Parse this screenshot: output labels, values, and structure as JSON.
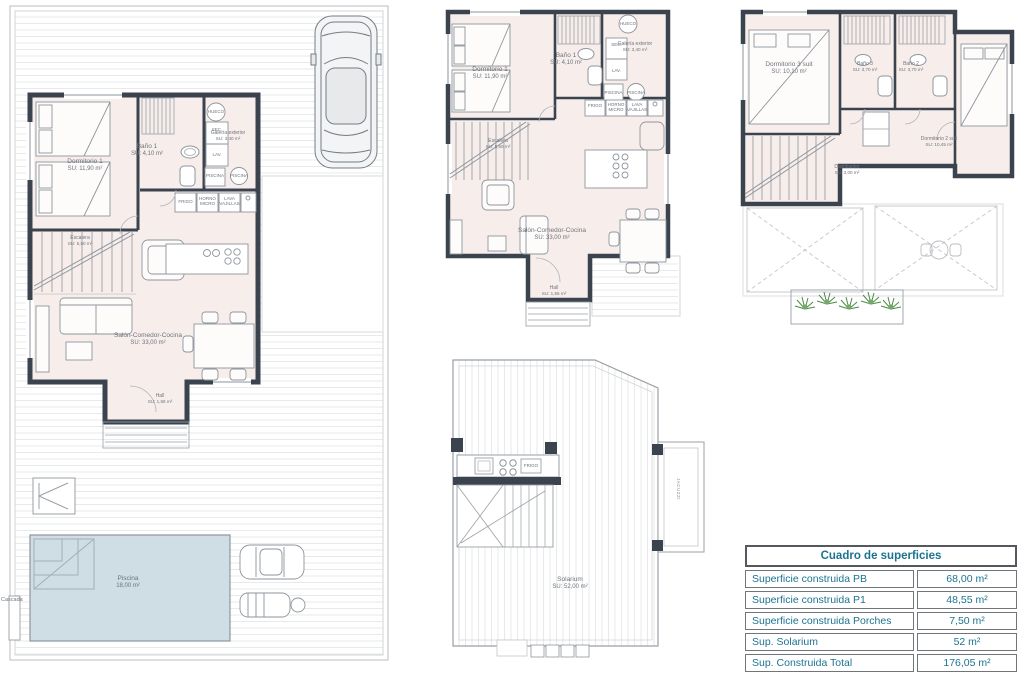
{
  "colors": {
    "wall": "#3b434f",
    "room_fill": "#f7eeec",
    "pool_fill": "#cfdde4",
    "furniture_line": "#8e959c",
    "terrace_line": "#e7e9ea",
    "table_text": "#1c7390",
    "plant_green": "#4e8a46",
    "label_text": "#6d747c"
  },
  "pb_site": {
    "rooms": {
      "dormitorio1": {
        "name": "Dormitorio 1",
        "area": "SU: 11,90 m²"
      },
      "bano1": {
        "name": "Baño 1",
        "area": "SU: 4,10 m²"
      },
      "galeria": {
        "name": "Galería exterior",
        "area": "SU: 3,40 m²"
      },
      "escalera": {
        "name": "Escalera",
        "area": "SU: 5,50 m²"
      },
      "salon": {
        "name": "Salón-Comedor-Cocina",
        "area": "SU: 33,00 m²"
      },
      "hall": {
        "name": "Hall",
        "area": "SU: 1,55 m²"
      },
      "piscina": {
        "name": "Piscina",
        "area": "18,00 m²"
      }
    },
    "appliances": {
      "hueco": "HUECO",
      "sec": "SEC.",
      "lav": "LAV.",
      "piscina_box": "PISCINA",
      "piscina_circle": "PISCINA",
      "frigo": "FRIGO",
      "horno": "HORNO MICRO",
      "lava": "LAVA VAJILLAS"
    },
    "cascada": "Cascada"
  },
  "pb_detail": {
    "rooms": {
      "dormitorio1": {
        "name": "Dormitorio 1",
        "area": "SU: 11,90 m²"
      },
      "bano1": {
        "name": "Baño 1",
        "area": "SU: 4,10 m²"
      },
      "galeria": {
        "name": "Galería exterior",
        "area": "SU: 3,40 m²"
      },
      "escalera": {
        "name": "Escalera",
        "area": "SU: 5,50 m²"
      },
      "salon": {
        "name": "Salón-Comedor-Cocina",
        "area": "SU: 33,00 m²"
      },
      "hall": {
        "name": "Hall",
        "area": "SU: 1,55 m²"
      }
    },
    "appliances": {
      "hueco": "HUECO",
      "sec": "SEC.",
      "lav": "LAV.",
      "piscina_box": "PISCINA",
      "piscina_circle": "PISCINA",
      "frigo": "FRIGO",
      "horno": "HORNO MICRO",
      "lava": "LAVA VAJILLAS"
    }
  },
  "p1": {
    "rooms": {
      "dormitorio3": {
        "name": "Dormitorio 3 suit",
        "area": "SU: 10,10 m²"
      },
      "bano3": {
        "name": "Baño 3",
        "area": "SU: 3,70 m²"
      },
      "bano2": {
        "name": "Baño 2",
        "area": "SU: 3,70 m²"
      },
      "dormitorio2": {
        "name": "Dormitorio 2 suit",
        "area": "SU: 10,45 m²"
      },
      "distribuidor": {
        "name": "Distribuidor",
        "area": "SU: 3,00 m²"
      }
    }
  },
  "solarium": {
    "room": {
      "name": "Solarium",
      "area": "SU: 52,00 m²"
    },
    "jacuzzi": "JACUZZI",
    "frigo": "FRIGO"
  },
  "surface_table": {
    "title": "Cuadro de superficies",
    "rows": [
      {
        "label": "Superficie construida PB",
        "value": "68,00 m²"
      },
      {
        "label": "Superficie construida P1",
        "value": "48,55 m²"
      },
      {
        "label": "Superficie construida Porches",
        "value": "7,50 m²"
      },
      {
        "label": "Sup. Solarium",
        "value": "52 m²"
      },
      {
        "label": "Sup. Construida Total",
        "value": "176,05 m²"
      }
    ]
  }
}
